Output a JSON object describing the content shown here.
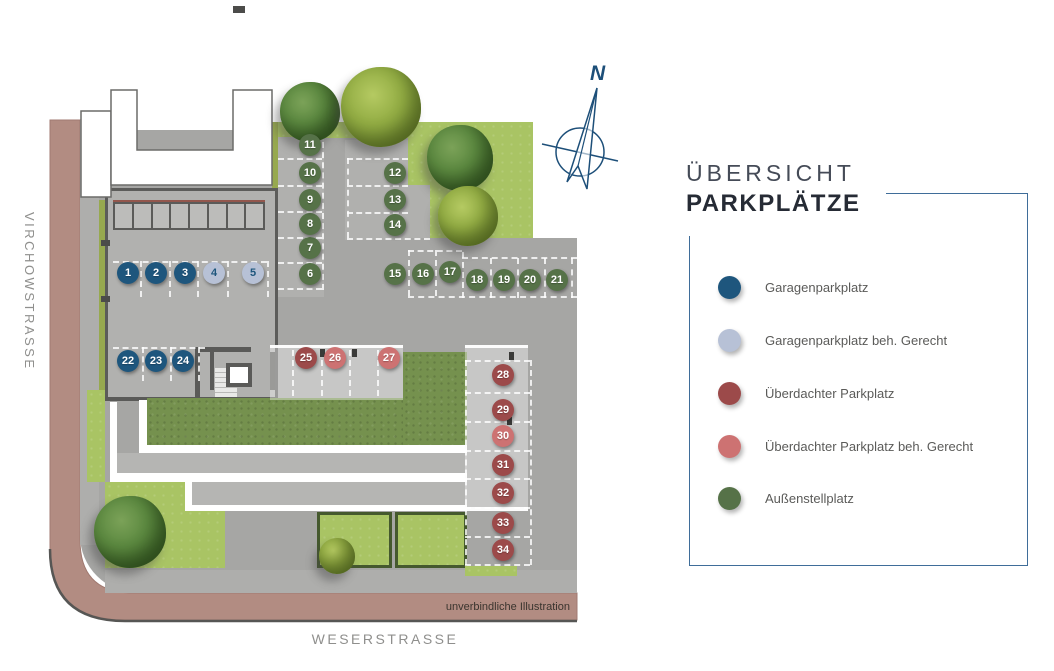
{
  "title": {
    "line1": "ÜBERSICHT",
    "line2": "PARKPLÄTZE"
  },
  "streets": {
    "left": "VIRCHOWSTRASSE",
    "bottom": "WESERSTRASSE"
  },
  "disclaimer": "unverbindliche Illustration",
  "compass": {
    "label": "N"
  },
  "colors": {
    "garage": "#1e567d",
    "garage_beh": "#b7c1d6",
    "covered": "#9c4a4a",
    "covered_beh": "#cd7272",
    "outdoor": "#567248",
    "accent_line": "#3f6d99",
    "road": "#b28c82",
    "lawn": "#a9c464",
    "garden": "#75914e",
    "pavement": "#a6a6a4"
  },
  "legend": {
    "items": [
      {
        "type": "garage",
        "label": "Garagenparkplatz"
      },
      {
        "type": "garage_beh",
        "label": "Garagenparkplatz beh. Gerecht"
      },
      {
        "type": "covered",
        "label": "Überdachter Parkplatz"
      },
      {
        "type": "covered_beh",
        "label": "Überdachter Parkplatz beh. Gerecht"
      },
      {
        "type": "outdoor",
        "label": "Außenstellplatz"
      }
    ]
  },
  "spots": [
    {
      "n": 1,
      "x": 128,
      "y": 273,
      "type": "garage"
    },
    {
      "n": 2,
      "x": 156,
      "y": 273,
      "type": "garage"
    },
    {
      "n": 3,
      "x": 185,
      "y": 273,
      "type": "garage"
    },
    {
      "n": 4,
      "x": 214,
      "y": 273,
      "type": "garage_beh"
    },
    {
      "n": 5,
      "x": 253,
      "y": 273,
      "type": "garage_beh"
    },
    {
      "n": 6,
      "x": 310,
      "y": 274,
      "type": "outdoor"
    },
    {
      "n": 7,
      "x": 310,
      "y": 248,
      "type": "outdoor"
    },
    {
      "n": 8,
      "x": 310,
      "y": 224,
      "type": "outdoor"
    },
    {
      "n": 9,
      "x": 310,
      "y": 200,
      "type": "outdoor"
    },
    {
      "n": 10,
      "x": 310,
      "y": 173,
      "type": "outdoor"
    },
    {
      "n": 11,
      "x": 310,
      "y": 145,
      "type": "outdoor"
    },
    {
      "n": 12,
      "x": 395,
      "y": 173,
      "type": "outdoor"
    },
    {
      "n": 13,
      "x": 395,
      "y": 200,
      "type": "outdoor"
    },
    {
      "n": 14,
      "x": 395,
      "y": 225,
      "type": "outdoor"
    },
    {
      "n": 15,
      "x": 395,
      "y": 274,
      "type": "outdoor"
    },
    {
      "n": 16,
      "x": 423,
      "y": 274,
      "type": "outdoor"
    },
    {
      "n": 17,
      "x": 450,
      "y": 272,
      "type": "outdoor"
    },
    {
      "n": 18,
      "x": 477,
      "y": 280,
      "type": "outdoor"
    },
    {
      "n": 19,
      "x": 504,
      "y": 280,
      "type": "outdoor"
    },
    {
      "n": 20,
      "x": 530,
      "y": 280,
      "type": "outdoor"
    },
    {
      "n": 21,
      "x": 557,
      "y": 280,
      "type": "outdoor"
    },
    {
      "n": 22,
      "x": 128,
      "y": 361,
      "type": "garage"
    },
    {
      "n": 23,
      "x": 156,
      "y": 361,
      "type": "garage"
    },
    {
      "n": 24,
      "x": 183,
      "y": 361,
      "type": "garage"
    },
    {
      "n": 25,
      "x": 306,
      "y": 358,
      "type": "covered"
    },
    {
      "n": 26,
      "x": 335,
      "y": 358,
      "type": "covered_beh"
    },
    {
      "n": 27,
      "x": 389,
      "y": 358,
      "type": "covered_beh"
    },
    {
      "n": 28,
      "x": 503,
      "y": 375,
      "type": "covered"
    },
    {
      "n": 29,
      "x": 503,
      "y": 410,
      "type": "covered"
    },
    {
      "n": 30,
      "x": 503,
      "y": 436,
      "type": "covered_beh"
    },
    {
      "n": 31,
      "x": 503,
      "y": 465,
      "type": "covered"
    },
    {
      "n": 32,
      "x": 503,
      "y": 493,
      "type": "covered"
    },
    {
      "n": 33,
      "x": 503,
      "y": 523,
      "type": "covered"
    },
    {
      "n": 34,
      "x": 503,
      "y": 550,
      "type": "covered"
    }
  ]
}
